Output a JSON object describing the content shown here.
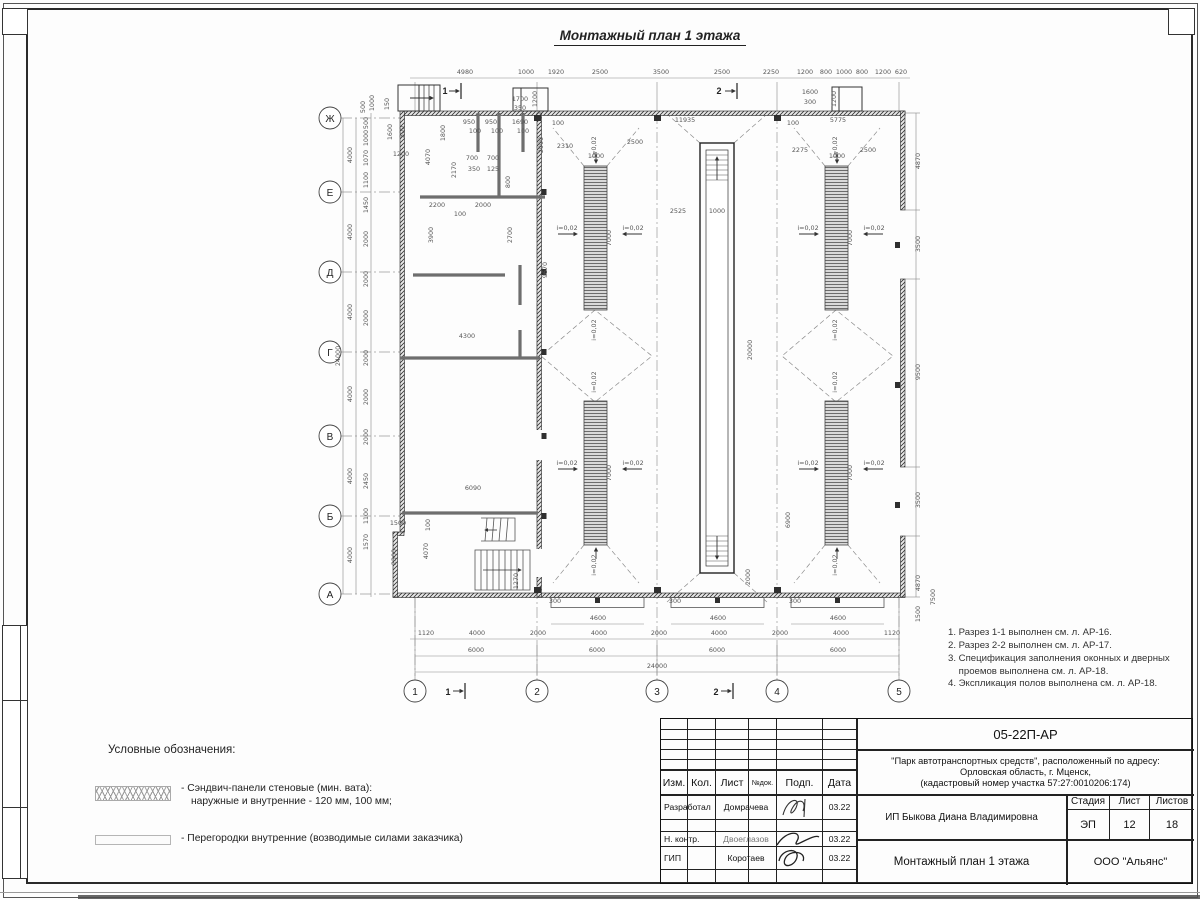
{
  "title": "Монтажный план 1 этажа",
  "axes": {
    "rows": [
      "Ж",
      "Е",
      "Д",
      "Г",
      "В",
      "Б",
      "А"
    ],
    "cols": [
      "1",
      "2",
      "3",
      "4",
      "5"
    ]
  },
  "sections": {
    "top1": "1",
    "top2": "2",
    "bottom1": "1",
    "bottom2": "2"
  },
  "notes": [
    "1. Разрез 1-1 выполнен см. л. АР-16.",
    "2. Разрез 2-2 выполнен см. л. АР-17.",
    "3. Спецификация заполнения оконных и дверных\n    проемов выполнена см. л. АР-18.",
    "4. Экспликация полов выполнена см. л. АР-18."
  ],
  "legend": {
    "title": "Условные обозначения:",
    "items": [
      {
        "symbol": "crosshatch-swatch",
        "line1": "- Сэндвич-панели стеновые (мин. вата):",
        "line2": "наружные и внутренние - 120 мм, 100 мм;"
      },
      {
        "symbol": "plain-swatch",
        "line1": "- Перегородки внутренние (возводимые силами заказчика)",
        "line2": ""
      }
    ]
  },
  "title_block": {
    "doc_code": "05-22П-АР",
    "project_line1": "\"Парк автотранспортных средств\",  расположенный по адресу:",
    "project_line2": "Орловская область, г. Мценск,",
    "project_line3": "(кадастровый номер участка 57:27:0010206:174)",
    "client": "ИП Быкова Диана Владимировна",
    "sheet_title": "Монтажный план 1 этажа",
    "company": "ООО \"Альянс\"",
    "header": [
      "Изм.",
      "Кол.",
      "Лист",
      "№док.",
      "Подп.",
      "Дата"
    ],
    "stamp_labels": [
      "Стадия",
      "Лист",
      "Листов"
    ],
    "stage": "ЭП",
    "sheet": "12",
    "sheets": "18",
    "rows": [
      {
        "role": "Разработал",
        "name": "Домрачева",
        "date": "03.22"
      },
      {
        "role": "Н. контр.",
        "name": "Двоеглазов",
        "date": "03.22"
      },
      {
        "role": "ГИП",
        "name": "Коротаев",
        "date": "03.22"
      }
    ]
  },
  "plan_labels": [
    {
      "t": "4980",
      "x": 150,
      "y": 22
    },
    {
      "t": "1000",
      "x": 211,
      "y": 22
    },
    {
      "t": "1920",
      "x": 241,
      "y": 22
    },
    {
      "t": "2500",
      "x": 285,
      "y": 22
    },
    {
      "t": "3500",
      "x": 346,
      "y": 22
    },
    {
      "t": "2500",
      "x": 407,
      "y": 22
    },
    {
      "t": "2250",
      "x": 456,
      "y": 22
    },
    {
      "t": "1200",
      "x": 490,
      "y": 22
    },
    {
      "t": "800",
      "x": 511,
      "y": 22
    },
    {
      "t": "1000",
      "x": 529,
      "y": 22
    },
    {
      "t": "800",
      "x": 547,
      "y": 22
    },
    {
      "t": "1200",
      "x": 568,
      "y": 22
    },
    {
      "t": "620",
      "x": 586,
      "y": 22
    },
    {
      "t": "1700",
      "x": 205,
      "y": 49
    },
    {
      "t": "350",
      "x": 205,
      "y": 58
    },
    {
      "t": "1200",
      "x": 222,
      "y": 47,
      "r": 1
    },
    {
      "t": "1600",
      "x": 495,
      "y": 42
    },
    {
      "t": "300",
      "x": 495,
      "y": 52
    },
    {
      "t": "1200",
      "x": 521,
      "y": 47,
      "r": 1
    },
    {
      "t": "500",
      "x": 50,
      "y": 55,
      "r": 1
    },
    {
      "t": "1000",
      "x": 59,
      "y": 51,
      "r": 1
    },
    {
      "t": "150",
      "x": 74,
      "y": 52,
      "r": 1
    },
    {
      "t": "24000",
      "x": 25,
      "y": 304,
      "r": 1
    },
    {
      "t": "4000",
      "x": 37,
      "y": 103,
      "r": 1
    },
    {
      "t": "4000",
      "x": 37,
      "y": 180,
      "r": 1
    },
    {
      "t": "4000",
      "x": 37,
      "y": 260,
      "r": 1
    },
    {
      "t": "4000",
      "x": 37,
      "y": 342,
      "r": 1
    },
    {
      "t": "4000",
      "x": 37,
      "y": 424,
      "r": 1
    },
    {
      "t": "4000",
      "x": 37,
      "y": 503,
      "r": 1
    },
    {
      "t": "500",
      "x": 53,
      "y": 71,
      "r": 1
    },
    {
      "t": "1000",
      "x": 53,
      "y": 86,
      "r": 1
    },
    {
      "t": "1070",
      "x": 53,
      "y": 106,
      "r": 1
    },
    {
      "t": "1100",
      "x": 53,
      "y": 128,
      "r": 1
    },
    {
      "t": "1450",
      "x": 53,
      "y": 153,
      "r": 1
    },
    {
      "t": "2000",
      "x": 53,
      "y": 187,
      "r": 1
    },
    {
      "t": "2000",
      "x": 53,
      "y": 227,
      "r": 1
    },
    {
      "t": "2000",
      "x": 53,
      "y": 266,
      "r": 1
    },
    {
      "t": "2000",
      "x": 53,
      "y": 306,
      "r": 1
    },
    {
      "t": "2000",
      "x": 53,
      "y": 345,
      "r": 1
    },
    {
      "t": "2000",
      "x": 53,
      "y": 385,
      "r": 1
    },
    {
      "t": "2450",
      "x": 53,
      "y": 429,
      "r": 1
    },
    {
      "t": "1100",
      "x": 53,
      "y": 464,
      "r": 1
    },
    {
      "t": "1570",
      "x": 53,
      "y": 490,
      "r": 1
    },
    {
      "t": "1120",
      "x": 111,
      "y": 583
    },
    {
      "t": "4000",
      "x": 162,
      "y": 583
    },
    {
      "t": "2000",
      "x": 223,
      "y": 583
    },
    {
      "t": "4000",
      "x": 284,
      "y": 583
    },
    {
      "t": "2000",
      "x": 344,
      "y": 583
    },
    {
      "t": "4000",
      "x": 404,
      "y": 583
    },
    {
      "t": "2000",
      "x": 465,
      "y": 583
    },
    {
      "t": "4000",
      "x": 526,
      "y": 583
    },
    {
      "t": "1120",
      "x": 577,
      "y": 583
    },
    {
      "t": "6000",
      "x": 161,
      "y": 600
    },
    {
      "t": "6000",
      "x": 282,
      "y": 600
    },
    {
      "t": "6000",
      "x": 402,
      "y": 600
    },
    {
      "t": "6000",
      "x": 523,
      "y": 600
    },
    {
      "t": "24000",
      "x": 342,
      "y": 616
    },
    {
      "t": "4600",
      "x": 283,
      "y": 568
    },
    {
      "t": "4600",
      "x": 403,
      "y": 568
    },
    {
      "t": "4600",
      "x": 523,
      "y": 568
    },
    {
      "t": "300",
      "x": 240,
      "y": 551
    },
    {
      "t": "300",
      "x": 360,
      "y": 551
    },
    {
      "t": "300",
      "x": 480,
      "y": 551
    },
    {
      "t": "4870",
      "x": 605,
      "y": 109,
      "r": 1
    },
    {
      "t": "3500",
      "x": 605,
      "y": 192,
      "r": 1
    },
    {
      "t": "9500",
      "x": 605,
      "y": 320,
      "r": 1
    },
    {
      "t": "3500",
      "x": 605,
      "y": 448,
      "r": 1
    },
    {
      "t": "4870",
      "x": 605,
      "y": 531,
      "r": 1
    },
    {
      "t": "1500",
      "x": 605,
      "y": 562,
      "r": 1
    },
    {
      "t": "7500",
      "x": 620,
      "y": 545,
      "r": 1
    },
    {
      "t": "100",
      "x": 243,
      "y": 73
    },
    {
      "t": "11935",
      "x": 370,
      "y": 70
    },
    {
      "t": "2310",
      "x": 250,
      "y": 96
    },
    {
      "t": "2500",
      "x": 320,
      "y": 92
    },
    {
      "t": "1000",
      "x": 281,
      "y": 106
    },
    {
      "t": "5775",
      "x": 523,
      "y": 70
    },
    {
      "t": "100",
      "x": 478,
      "y": 73
    },
    {
      "t": "2275",
      "x": 485,
      "y": 100
    },
    {
      "t": "2500",
      "x": 553,
      "y": 100
    },
    {
      "t": "1000",
      "x": 522,
      "y": 106
    },
    {
      "t": "2525",
      "x": 363,
      "y": 161
    },
    {
      "t": "1000",
      "x": 402,
      "y": 161
    },
    {
      "t": "20000",
      "x": 437,
      "y": 298,
      "r": 1
    },
    {
      "t": "2000",
      "x": 435,
      "y": 525,
      "r": 1
    },
    {
      "t": "7000",
      "x": 296,
      "y": 186,
      "r": 1
    },
    {
      "t": "7000",
      "x": 537,
      "y": 186,
      "r": 1
    },
    {
      "t": "7000",
      "x": 296,
      "y": 421,
      "r": 1
    },
    {
      "t": "7000",
      "x": 537,
      "y": 421,
      "r": 1
    },
    {
      "t": "i=0,02",
      "x": 252,
      "y": 178
    },
    {
      "t": "i=0,02",
      "x": 318,
      "y": 178
    },
    {
      "t": "i=0,02",
      "x": 493,
      "y": 178
    },
    {
      "t": "i=0,02",
      "x": 559,
      "y": 178
    },
    {
      "t": "i=0,02",
      "x": 252,
      "y": 413
    },
    {
      "t": "i=0,02",
      "x": 318,
      "y": 413
    },
    {
      "t": "i=0,02",
      "x": 493,
      "y": 413
    },
    {
      "t": "i=0,02",
      "x": 559,
      "y": 413
    },
    {
      "t": "i=0,02",
      "x": 281,
      "y": 95,
      "r": 1
    },
    {
      "t": "i=0,02",
      "x": 522,
      "y": 95,
      "r": 1
    },
    {
      "t": "i=0,02",
      "x": 281,
      "y": 278,
      "r": 1
    },
    {
      "t": "i=0,02",
      "x": 522,
      "y": 278,
      "r": 1
    },
    {
      "t": "i=0,02",
      "x": 281,
      "y": 330,
      "r": 1
    },
    {
      "t": "i=0,02",
      "x": 522,
      "y": 330,
      "r": 1
    },
    {
      "t": "i=0,02",
      "x": 281,
      "y": 513,
      "r": 1
    },
    {
      "t": "i=0,02",
      "x": 522,
      "y": 513,
      "r": 1
    },
    {
      "t": "950",
      "x": 154,
      "y": 72
    },
    {
      "t": "950",
      "x": 176,
      "y": 72
    },
    {
      "t": "1690",
      "x": 205,
      "y": 72
    },
    {
      "t": "100",
      "x": 160,
      "y": 81
    },
    {
      "t": "100",
      "x": 182,
      "y": 81
    },
    {
      "t": "100",
      "x": 208,
      "y": 81
    },
    {
      "t": "1800",
      "x": 130,
      "y": 81,
      "r": 1
    },
    {
      "t": "4070",
      "x": 115,
      "y": 105,
      "r": 1
    },
    {
      "t": "2170",
      "x": 141,
      "y": 118,
      "r": 1
    },
    {
      "t": "700",
      "x": 157,
      "y": 108
    },
    {
      "t": "700",
      "x": 178,
      "y": 108
    },
    {
      "t": "350",
      "x": 159,
      "y": 119
    },
    {
      "t": "125",
      "x": 178,
      "y": 119
    },
    {
      "t": "800",
      "x": 195,
      "y": 130,
      "r": 1
    },
    {
      "t": "2000",
      "x": 228,
      "y": 93,
      "r": 1
    },
    {
      "t": "2200",
      "x": 122,
      "y": 155
    },
    {
      "t": "2000",
      "x": 168,
      "y": 155
    },
    {
      "t": "100",
      "x": 145,
      "y": 164
    },
    {
      "t": "3900",
      "x": 118,
      "y": 183,
      "r": 1
    },
    {
      "t": "2700",
      "x": 197,
      "y": 183,
      "r": 1
    },
    {
      "t": "9670",
      "x": 232,
      "y": 218,
      "r": 1
    },
    {
      "t": "4300",
      "x": 152,
      "y": 286
    },
    {
      "t": "1200",
      "x": 86,
      "y": 104
    },
    {
      "t": "1600",
      "x": 77,
      "y": 80,
      "r": 1
    },
    {
      "t": "300",
      "x": 89,
      "y": 80,
      "r": 1
    },
    {
      "t": "6090",
      "x": 158,
      "y": 438
    },
    {
      "t": "100",
      "x": 115,
      "y": 473,
      "r": 1
    },
    {
      "t": "4070",
      "x": 113,
      "y": 499,
      "r": 1
    },
    {
      "t": "1270",
      "x": 203,
      "y": 529,
      "r": 1
    },
    {
      "t": "1500",
      "x": 83,
      "y": 473
    },
    {
      "t": "2300",
      "x": 81,
      "y": 505,
      "r": 1
    },
    {
      "t": "6900",
      "x": 475,
      "y": 468,
      "r": 1
    }
  ]
}
